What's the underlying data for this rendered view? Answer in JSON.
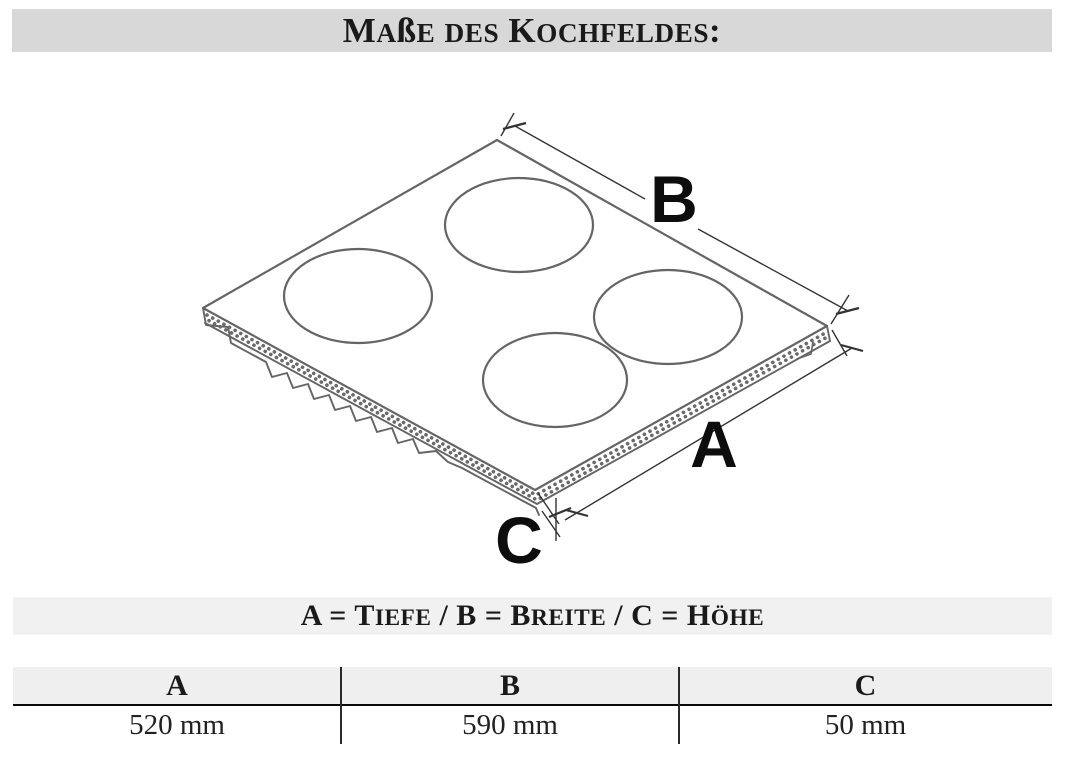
{
  "header": {
    "title": "Maße des Kochfeldes:",
    "bg": "#d8d8d8"
  },
  "diagram": {
    "type": "isometric-cooktop-line-drawing",
    "burner_count": 4,
    "labels": {
      "breite_label": "B",
      "tiefe_label": "A",
      "hoehe_label": "C"
    },
    "line_color": "#585858",
    "dim_line_color": "#333333",
    "label_color": "#0d0d0d"
  },
  "legend": {
    "text": "A = Tiefe / B = Breite / C = Höhe",
    "bg": "#f1f1f1"
  },
  "table": {
    "header_bg": "#efefef",
    "columns": [
      "A",
      "B",
      "C"
    ],
    "values": [
      "520 mm",
      "590 mm",
      "50 mm"
    ]
  }
}
